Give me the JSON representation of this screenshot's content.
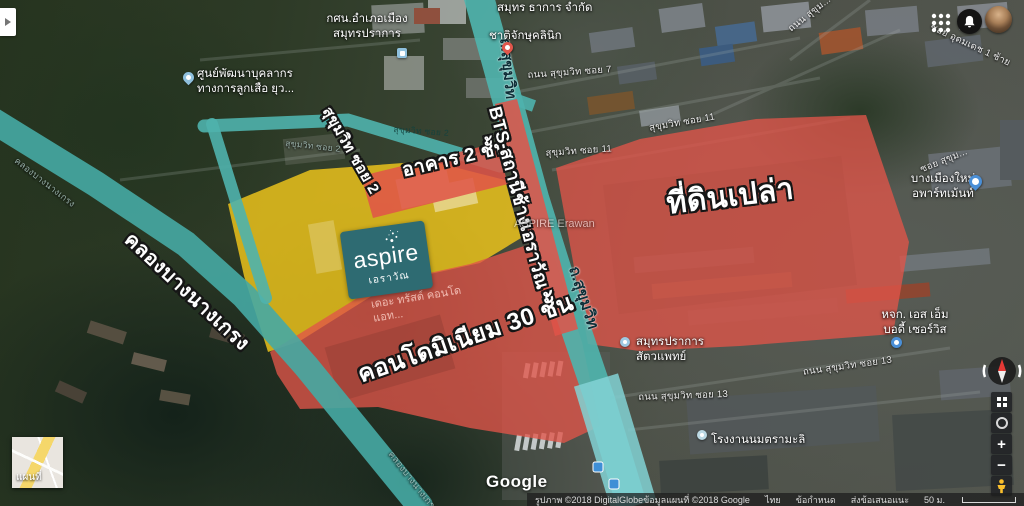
{
  "annotations": {
    "building": "อาคาร 2 ชั้น",
    "bts": "BTS สถานีช้างเอราวัณ",
    "land": "ที่ดินเปล่า",
    "condo": "คอนโดมิเนียม 30 ชั้น",
    "canal": "คลองบางนางเกรง",
    "soi2": "สุขุมวิท ซอย 2"
  },
  "logo": {
    "brand": "aspire",
    "subtitle": "เอราวัณ"
  },
  "pois": {
    "nfe": {
      "line1": "กศน.อำเภอเมือง",
      "line2": "สมุทรปราการ"
    },
    "scout": {
      "line1": "ศูนย์พัฒนาบุคลากร",
      "line2": "ทางการลูกเสือ ยุว..."
    },
    "company": {
      "line1": "สมุทร ธาการ จำกัด"
    },
    "clinic": {
      "line1": "ชาติจักษุคลินิก"
    },
    "apartment": {
      "line1": "บางเมืองใหม่",
      "line2": "อพาร์ทเม้นท์"
    },
    "body_service": {
      "line1": "หจก. เอส เอ็ม",
      "line2": "บอดี้ เซอร์วิส"
    },
    "vet": {
      "line1": "สมุทรปราการ",
      "line2": "สัตวแพทย์"
    },
    "milk_factory": {
      "line1": "โรงงานนมตรามะลิ"
    },
    "aspire_erawan": {
      "line1": "ASPIRE Erawan"
    },
    "trust_condo": {
      "line1": "เดอะ ทรัสต์ คอนโด",
      "line2": "แอท..."
    }
  },
  "streets": {
    "soi7": "ถนน สุขุมวิท ซอย 7",
    "soi11a": "สุขุมวิท ซอย 11",
    "soi11b": "สุขุมวิท ซอย 11",
    "soi13a": "ถนน สุขุมวิท ซอย 13",
    "soi13b": "ถนน สุขุมวิท ซอย 13",
    "udomdet": "ซอย อุดมเดช 1 ซ้าย",
    "soi_sukhum_right": "ซอย สุขุม...",
    "thanon_top": "ถนน สุขุม...",
    "sukhumvit_top": "ถ.สุขุมวิท",
    "sukhumvit_bottom": "ถ.สุขุมวิท",
    "soi2_faint_a": "สุขุมวิท ซอย 2",
    "soi2_faint_b": "สุขุมวิท ซอย 2",
    "canal_faint_a": "คลองบางนางเกรง",
    "canal_faint_b": "คลองบางนางเกรง"
  },
  "controls": {
    "zoom_in": "+",
    "zoom_out": "−"
  },
  "minimap": {
    "label": "แผนที่"
  },
  "footer": {
    "google": "Google",
    "imagery": "รูปภาพ ©2018 DigitalGlobeข้อมูลแผนที่ ©2018 Google",
    "country": "ไทย",
    "terms": "ข้อกำหนด",
    "feedback": "ส่งข้อเสนอแนะ",
    "scale": "50 ม."
  },
  "colors": {
    "overlay_red": "#e05449",
    "overlay_yellow": "#f2c71b",
    "road_teal": "#4fb3ad",
    "logo_teal": "#2e6b72"
  }
}
